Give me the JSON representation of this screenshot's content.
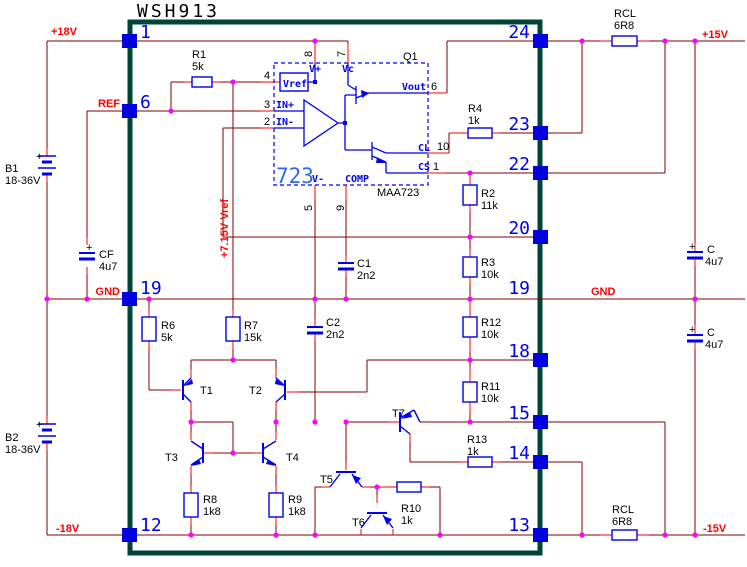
{
  "title": "WSH913",
  "nets": {
    "vin_pos": "+18V",
    "ref": "REF",
    "gnd_left": "GND",
    "vin_neg": "-18V",
    "vout_pos": "+15V",
    "gnd_right": "GND",
    "vout_neg": "-15V",
    "vref_rail": "+7.15V Vref"
  },
  "pins": {
    "p1": "1",
    "p6": "6",
    "p19l": "19",
    "p12": "12",
    "p24": "24",
    "p23": "23",
    "p22": "22",
    "p20": "20",
    "p19r": "19",
    "p18": "18",
    "p15": "15",
    "p14": "14",
    "p13": "13"
  },
  "ic723": {
    "name": "723",
    "part": "MAA723",
    "q1": "Q1",
    "vref_box": "Vref",
    "vplus": "V+",
    "vc": "Vc",
    "vout": "Vout",
    "inp": "IN+",
    "inn": "IN-",
    "vminus": "V-",
    "comp": "COMP",
    "cl": "CL",
    "cs": "CS",
    "n1": "1",
    "n2": "2",
    "n3": "3",
    "n4": "4",
    "n5": "5",
    "n6": "6",
    "n7": "7",
    "n8": "8",
    "n9": "9",
    "n10": "10"
  },
  "components": {
    "r1": {
      "ref": "R1",
      "value": "5k"
    },
    "r2": {
      "ref": "R2",
      "value": "11k"
    },
    "r3": {
      "ref": "R3",
      "value": "10k"
    },
    "r4": {
      "ref": "R4",
      "value": "1k"
    },
    "r6": {
      "ref": "R6",
      "value": "5k"
    },
    "r7": {
      "ref": "R7",
      "value": "15k"
    },
    "r8": {
      "ref": "R8",
      "value": "1k8"
    },
    "r9": {
      "ref": "R9",
      "value": "1k8"
    },
    "r10": {
      "ref": "R10",
      "value": "1k"
    },
    "r11": {
      "ref": "R11",
      "value": "10k"
    },
    "r12": {
      "ref": "R12",
      "value": "10k"
    },
    "r13": {
      "ref": "R13",
      "value": "1k"
    },
    "rcl_top": {
      "ref": "RCL",
      "value": "6R8"
    },
    "rcl_bottom": {
      "ref": "RCL",
      "value": "6R8"
    },
    "c1": {
      "ref": "C1",
      "value": "2n2"
    },
    "c2": {
      "ref": "C2",
      "value": "2n2"
    },
    "cf": {
      "ref": "CF",
      "value": "4u7",
      "plus": "+"
    },
    "c_top": {
      "ref": "C",
      "value": "4u7",
      "plus": "+"
    },
    "c_bottom": {
      "ref": "C",
      "value": "4u7",
      "plus": "+"
    },
    "b1": {
      "ref": "B1",
      "value": "18-36V",
      "plus": "+"
    },
    "b2": {
      "ref": "B2",
      "value": "18-36V",
      "plus": "+"
    },
    "t1": {
      "ref": "T1"
    },
    "t2": {
      "ref": "T2"
    },
    "t3": {
      "ref": "T3"
    },
    "t4": {
      "ref": "T4"
    },
    "t5": {
      "ref": "T5"
    },
    "t6": {
      "ref": "T6"
    },
    "t7": {
      "ref": "T7"
    }
  },
  "colors": {
    "wire": "#800000",
    "lead": "#ff0000",
    "component_blue": "#0000ee",
    "junction": "#ff00ff",
    "ic_outline": "#004438",
    "pad_blue": "#0000e0"
  }
}
